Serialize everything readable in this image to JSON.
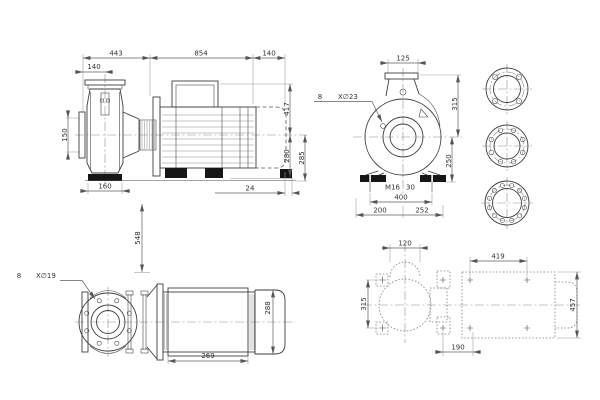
{
  "drawing": {
    "title": "Pump outline dimensional drawing",
    "colors": {
      "background": "#ffffff",
      "line": "#3f3f3f",
      "dimension": "#5f5f5f",
      "text": "#333333"
    },
    "views": {
      "side": {
        "dims": {
          "front_section": "443",
          "motor_section": "854",
          "rear_extension": "140",
          "suction_to_axis": "140",
          "suction_flange": "150",
          "foot_width": "160",
          "axis_to_top": "417",
          "axis_to_base": "280",
          "axis_to_floor": "285",
          "rear_offset": "24"
        }
      },
      "end": {
        "dims": {
          "discharge_flange": "125",
          "axis_to_top": "315",
          "axis_to_base": "250",
          "anchor_span": "400",
          "axis_left": "200",
          "axis_right": "252"
        },
        "notes": {
          "hole_count": "8",
          "hole_spec": "X∅23",
          "anchor_thread": "M16",
          "anchor_depth": "30"
        }
      },
      "top": {
        "dims": {
          "axis_height": "548",
          "stator_length": "269",
          "motor_width": "288"
        },
        "notes": {
          "hole_count": "8",
          "hole_spec": "X∅19"
        }
      },
      "foundation": {
        "dims": {
          "pump_bolt_span": "120",
          "motor_bolt_span": "419",
          "pump_bolt_width": "315",
          "motor_bolt_width": "457",
          "adapter_bolt_span": "190"
        }
      }
    },
    "flanges": {
      "items": [
        {
          "name": "flange-4-hole",
          "holes": 4
        },
        {
          "name": "flange-8-hole",
          "holes": 8
        },
        {
          "name": "flange-12-hole",
          "holes": 12
        },
        {
          "name": "discharge-flange-plan",
          "holes": 8
        }
      ]
    }
  }
}
